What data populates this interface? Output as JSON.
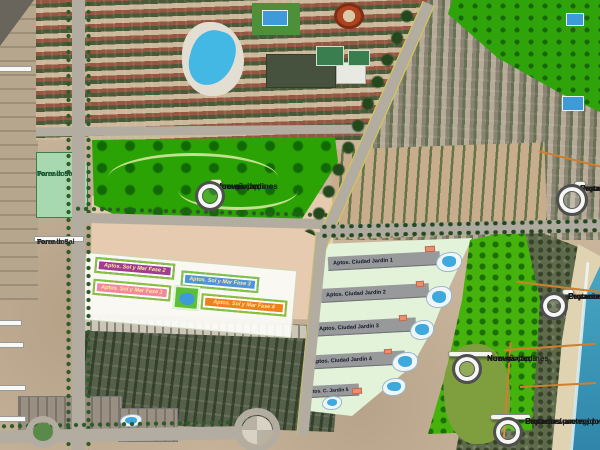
{
  "callouts": {
    "new_gardens": {
      "line1": "Nuevos jardines",
      "line2": "New gardens",
      "line3": "Новый сад"
    },
    "protected": {
      "line1": "Espacios protegidos",
      "line2": "Protected areas",
      "line3": "Охраняемые территории"
    }
  },
  "area_labels": {
    "pareados": {
      "line1": "Pareados",
      "line2": "Torre la Sal"
    }
  },
  "edge_labels": {
    "top_left_20min": {
      "line1": "to de",
      "line2": "(20')"
    },
    "a7": {
      "line1": "A7"
    },
    "ctra_340": {
      "line1": "tra.",
      "line2": "340"
    },
    "left_75min": {
      "line1": "to de",
      "line2": "(75')"
    },
    "ave": {
      "line1": "AVE",
      "line2": "5')"
    }
  },
  "buildings": {
    "sol_y_mar": [
      {
        "label": "Aptos. Sol y Mar Fase 2",
        "color": "#a03d92"
      },
      {
        "label": "Aptos. Sol y Mar Fase 3",
        "color": "#4f93d9"
      },
      {
        "label": "Aptos. Sol y Mar Fase 1",
        "color": "#f2879e"
      },
      {
        "label": "Aptos. Sol y Mar Fase 4",
        "color": "#f07f1e"
      }
    ],
    "ciudad_jardin": [
      {
        "label": "Aptos. Ciudad Jardín 1"
      },
      {
        "label": "Aptos. Ciudad Jardín 2"
      },
      {
        "label": "Aptos. Ciudad Jardín 3"
      },
      {
        "label": "Aptos. Ciudad Jardín 4"
      },
      {
        "label": "Aptos. C. Jardín 5"
      }
    ]
  },
  "colors": {
    "park_green": "#2ca305",
    "pale_zone_green": "#e2f3da",
    "protected_boundary": "#cf7f2e",
    "sea": "#3f9ec0",
    "pool_blue": "#3fa8dc"
  }
}
